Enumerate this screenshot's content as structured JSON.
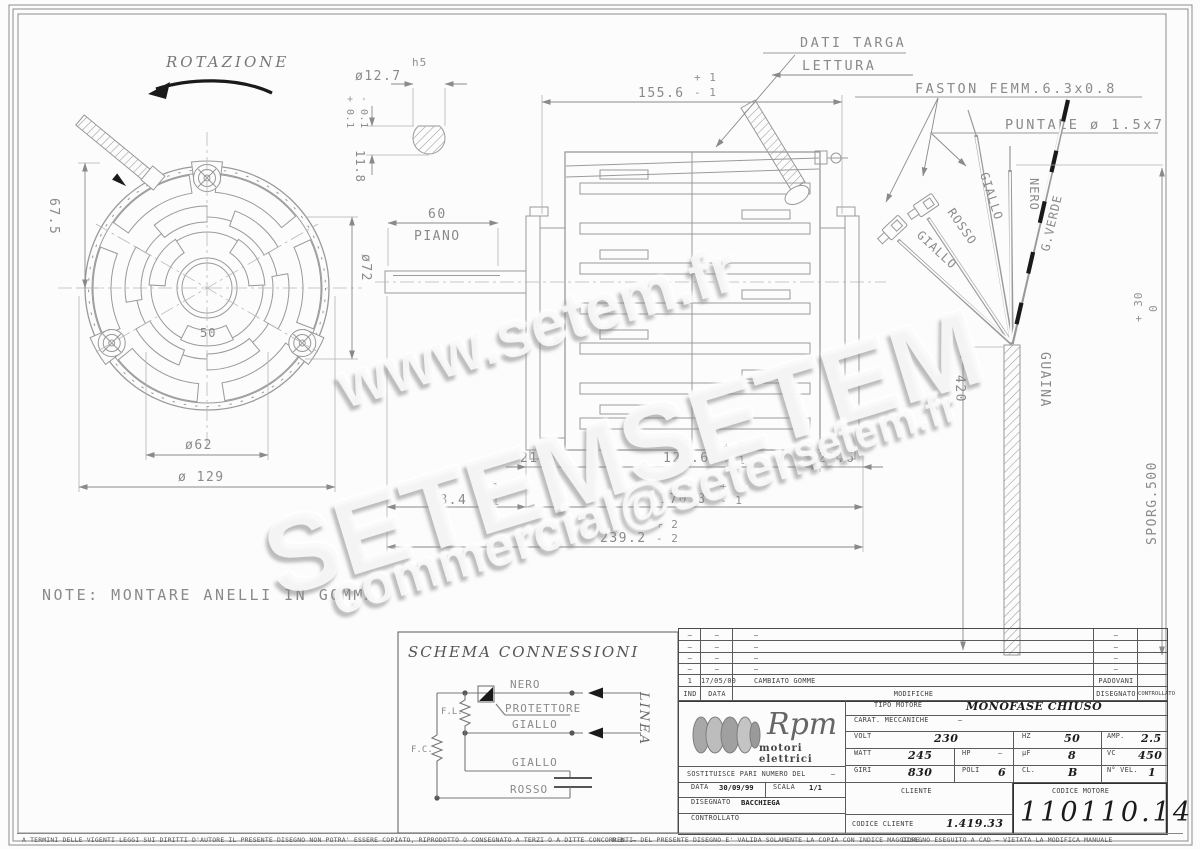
{
  "page": {
    "rotazione": "ROTAZIONE",
    "note": "NOTE: MONTARE ANELLI IN GOMMA"
  },
  "callouts": {
    "dati_targa": "DATI TARGA",
    "lettura": "LETTURA",
    "faston": "FASTON FEMM.6.3x0.8",
    "puntale": "PUNTALE ø 1.5x7"
  },
  "front_view": {
    "dim_67_5": "67.5",
    "dim_d72": "ø72",
    "dim_50": "50",
    "dim_d62": "ø62",
    "dim_d129": "ø 129"
  },
  "keyway": {
    "dim_d12_7": "ø12.7",
    "fit": "h5",
    "dim_11_8": "11.8",
    "tol_plus": "+ 0.1",
    "tol_minus": "- 0.1"
  },
  "side_view": {
    "dim_155_6": "155.6",
    "tol_plus_1": "+ 1",
    "tol_minus_1": "- 1",
    "dim_60": "60",
    "piano": "PIANO",
    "dim_21_6_left": "21.6",
    "dim_127_6": "127.6",
    "dim_21_6_right": "21.6",
    "dim_68_4": "68.4",
    "dim_170_8": "170.8",
    "dim_239_2": "239.2",
    "tol_plus_2": "+ 2",
    "tol_minus_2": "- 2"
  },
  "wires": {
    "giallo1": "GIALLO",
    "rosso": "ROSSO",
    "giallo2": "GIALLO",
    "nero": "NERO",
    "gverde": "G.VERDE",
    "guaina": "GUAINA",
    "dim_420": "420",
    "sporg": "SPORG.500",
    "sporg_tol_plus": "+ 30",
    "sporg_tol_minus": "0"
  },
  "schema": {
    "title": "SCHEMA CONNESSIONI",
    "nero": "NERO",
    "protettore": "PROTETTORE",
    "giallo1": "GIALLO",
    "giallo2": "GIALLO",
    "rosso": "ROSSO",
    "fl": "F.L.",
    "fc": "F.C.",
    "linea": "LINEA"
  },
  "title_block": {
    "revisions": {
      "rows": [
        {
          "ind": "–",
          "date": "–",
          "desc": "–",
          "by": "–"
        },
        {
          "ind": "–",
          "date": "–",
          "desc": "–",
          "by": "–"
        },
        {
          "ind": "–",
          "date": "–",
          "desc": "–",
          "by": "–"
        },
        {
          "ind": "–",
          "date": "–",
          "desc": "–",
          "by": "–"
        }
      ],
      "entry": {
        "ind": "1",
        "date": "17/05/00",
        "desc": "CAMBIATO GOMME",
        "by": "PADOVANI"
      },
      "headers": {
        "ind": "IND",
        "date": "DATA",
        "desc": "MODIFICHE",
        "drawn": "DISEGNATO",
        "checked": "CONTROLLATO"
      }
    },
    "logo": {
      "name": "Rpm",
      "tagline": "motori elettrici"
    },
    "sostituisce_label": "SOSTITUISCE PARI NUMERO DEL",
    "sostituisce_value": "–",
    "data_label": "DATA",
    "data_value": "30/09/99",
    "scala_label": "SCALA",
    "scala_value": "1/1",
    "disegnato_label": "DISEGNATO",
    "disegnato_value": "BACCHIEGA",
    "controllato_label": "CONTROLLATO",
    "tipo_label": "TIPO MOTORE",
    "tipo_value": "MONOFASE CHIUSO",
    "carat_label": "CARAT. MECCANICHE",
    "carat_value": "–",
    "volt_label": "VOLT",
    "volt": "230",
    "hz_label": "HZ",
    "hz": "50",
    "amp_label": "AMP.",
    "amp": "2.5",
    "watt_label": "WATT",
    "watt": "245",
    "hp_label": "HP",
    "hp": "–",
    "uf_label": "µF",
    "uf": "8",
    "vc_label": "VC",
    "vc": "450",
    "giri_label": "GIRI",
    "giri": "830",
    "poli_label": "POLI",
    "poli": "6",
    "cl_label": "CL.",
    "cl": "B",
    "nvel_label": "N° VEL.",
    "nvel": "1",
    "cliente_label": "CLIENTE",
    "codice_cliente_label": "CODICE CLIENTE",
    "codice_cliente": "1.419.33",
    "codice_motore_label": "CODICE MOTORE",
    "codice_motore": "110110.14"
  },
  "footer": {
    "left": "A TERMINI DELLE VIGENTI LEGGI SUI DIRITTI D'AUTORE IL PRESENTE DISEGNO NON POTRA' ESSERE COPIATO, RIPRODOTTO O CONSEGNATO A TERZI O A DITTE CONCORRENTI.",
    "right1": "N.B. – DEL PRESENTE DISEGNO E' VALIDA SOLAMENTE LA COPIA CON INDICE MAGGIORE.",
    "right2": "DISEGNO ESEGUITO A CAD – VIETATA LA MODIFICA MANUALE"
  },
  "watermarks": {
    "w1": "www.setem.fr",
    "w2": "SETEM",
    "w3": "SETEM",
    "w4": "commercial@setem.fr",
    "w5": "setem.fr"
  }
}
